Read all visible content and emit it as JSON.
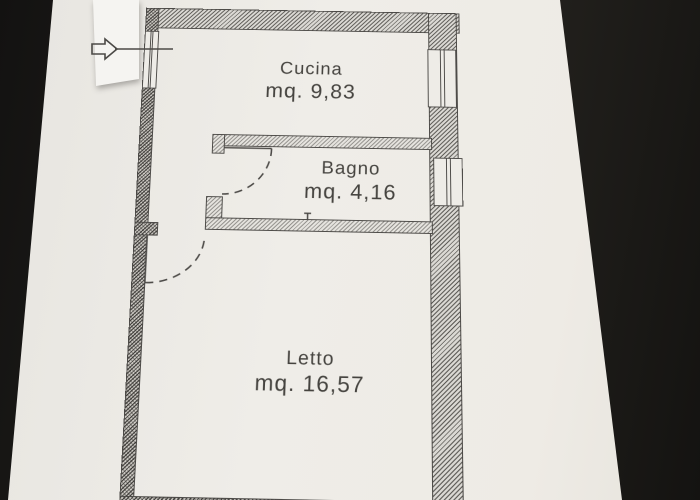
{
  "floorplan": {
    "rooms": [
      {
        "name": "Cucina",
        "area": "mq. 9,83"
      },
      {
        "name": "Bagno",
        "area": "mq. 4,16"
      },
      {
        "name": "Letto",
        "area": "mq. 16,57"
      }
    ],
    "entrance": {
      "icon": "arrow-right"
    }
  },
  "colors": {
    "paper": "#efede8",
    "ink": "#4c4a47",
    "background": "#1e1d1a"
  }
}
